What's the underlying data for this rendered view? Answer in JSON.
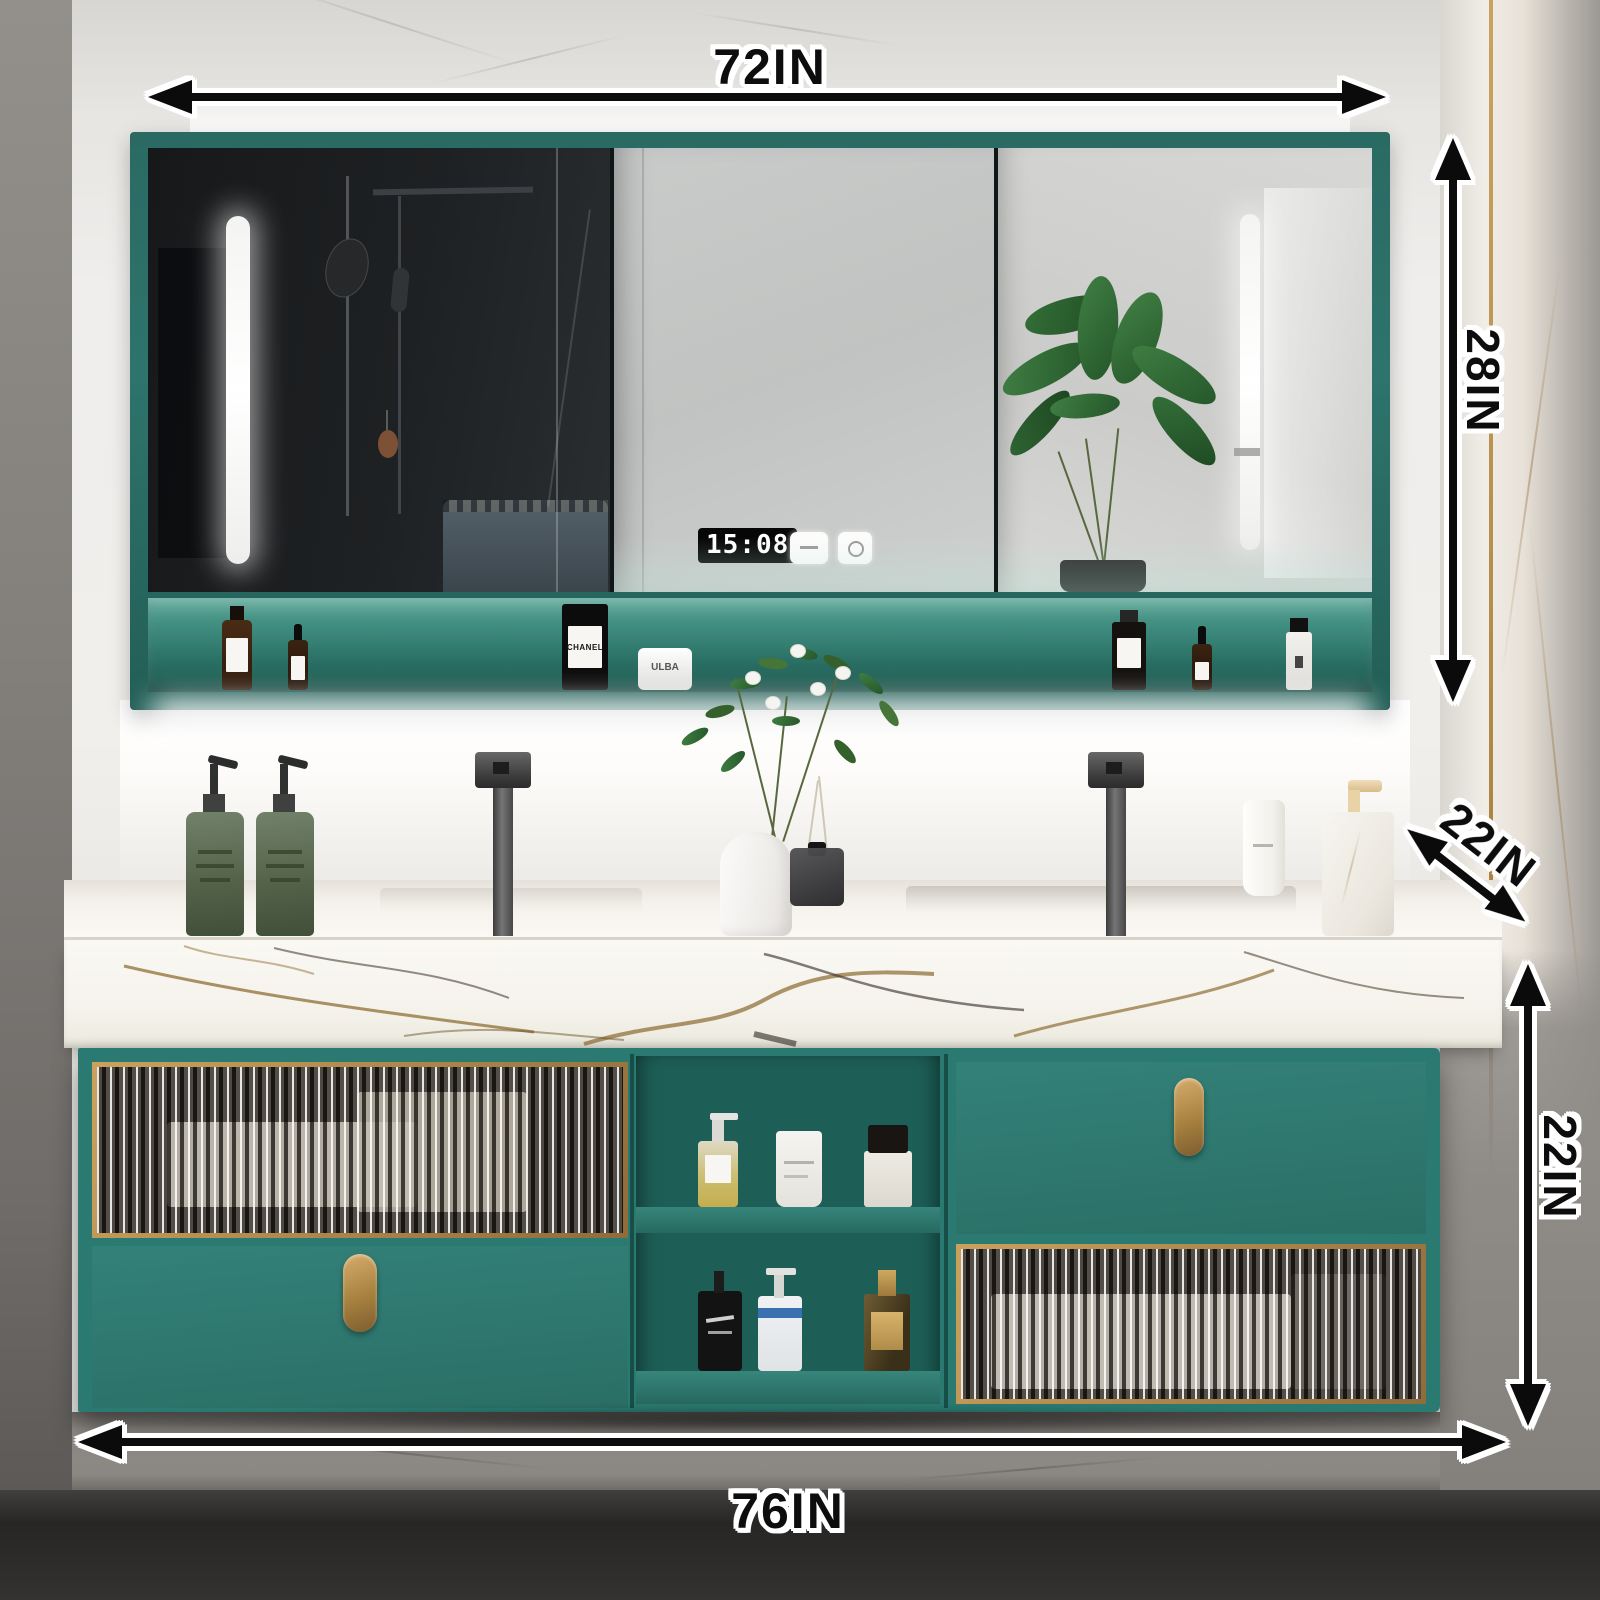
{
  "annotations": {
    "mirror_width_label": "72IN",
    "mirror_height_label": "28IN",
    "counter_depth_label": "22IN",
    "cabinet_height_label": "22IN",
    "vanity_width_label": "76IN"
  },
  "mirror": {
    "clock_time": "15:08"
  },
  "products": {
    "black_bottle_label": "CHANEL",
    "white_jar_label": "ULBA"
  },
  "palette": {
    "cabinet_teal": "#2e7e76",
    "frame_teal": "#2a6a63",
    "gold_accent": "#b68f55",
    "marble_white": "#f6f3ee",
    "annotation_black": "#0d0d0d",
    "led_white": "#ffffff"
  }
}
